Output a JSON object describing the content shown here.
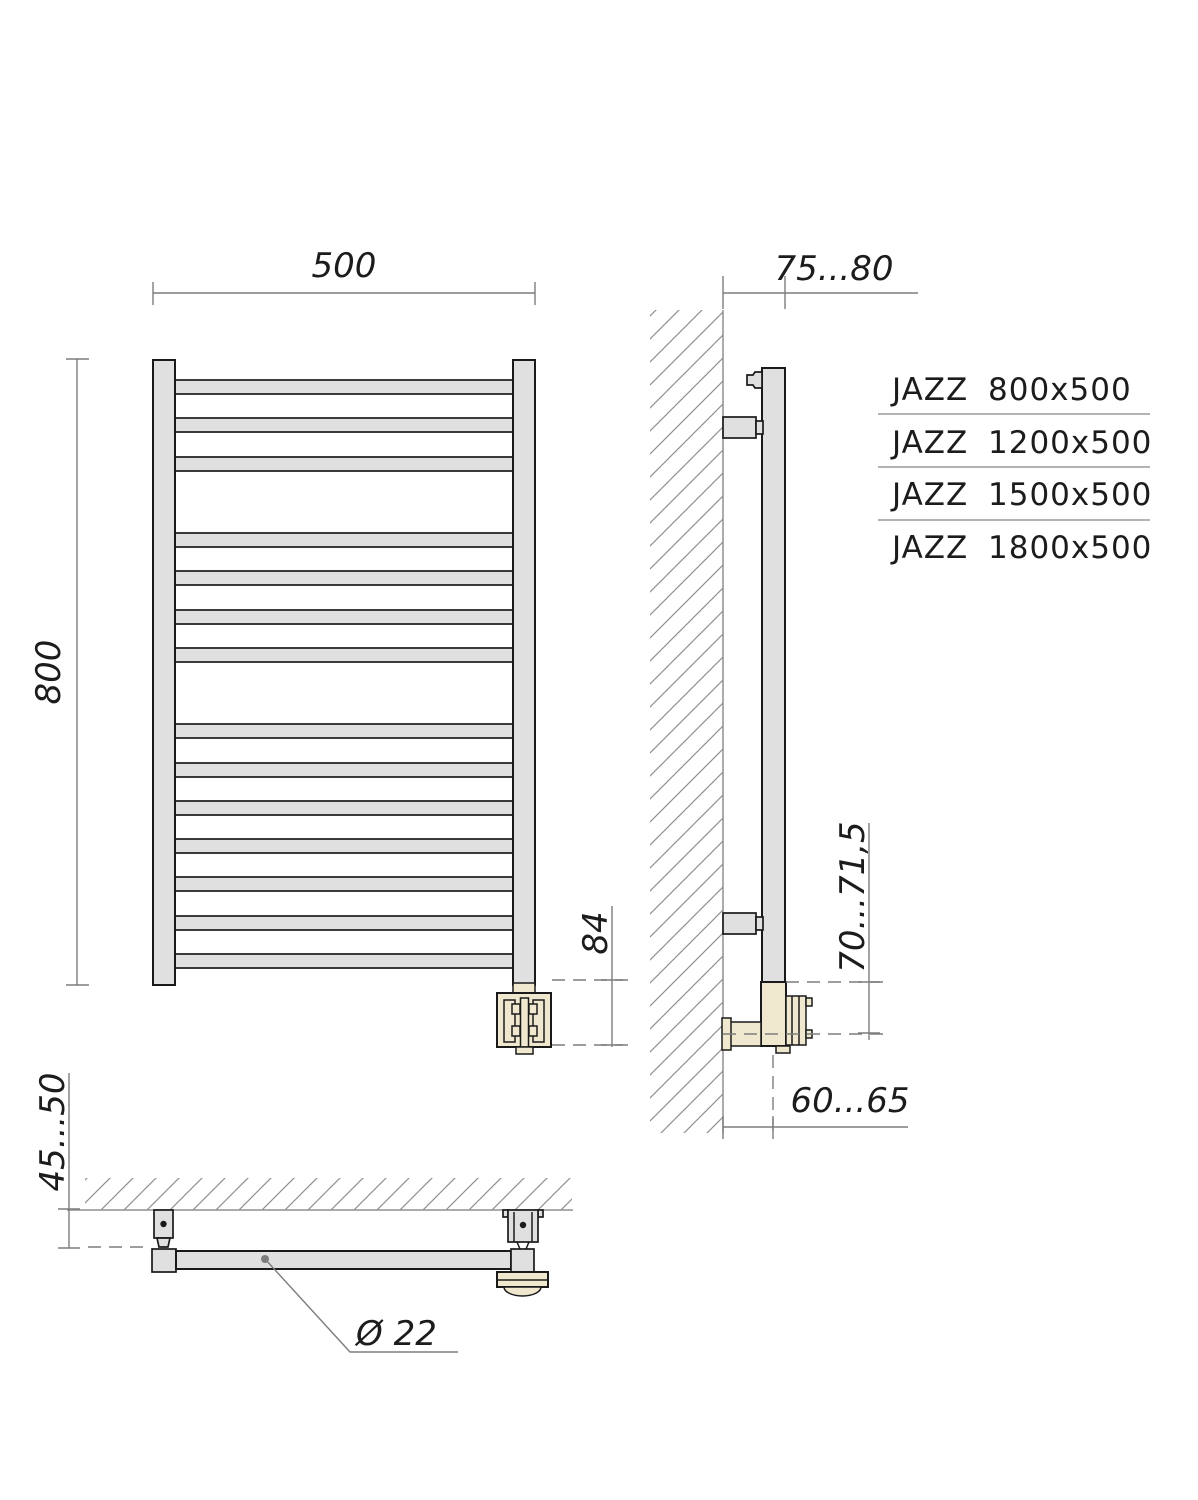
{
  "views": {
    "front": {
      "width_dim": "500",
      "height_dim": "800",
      "heater_offset_dim": "84"
    },
    "side": {
      "wall_offset_dim": "75...80",
      "connector_height_dim": "70...71,5",
      "connector_wall_offset_dim": "60...65"
    },
    "top": {
      "wall_gap_dim": "45...50",
      "tube_diameter_dim": "Ø 22"
    }
  },
  "models": [
    {
      "name": "JAZZ",
      "size": "800x500"
    },
    {
      "name": "JAZZ",
      "size": "1200x500"
    },
    {
      "name": "JAZZ",
      "size": "1500x500"
    },
    {
      "name": "JAZZ",
      "size": "1800x500"
    }
  ],
  "colors": {
    "tube_fill": "#e0e0e0",
    "fitting_fill": "#efe8ce",
    "outline": "#1a1a1a",
    "dimension_line": "#7d7d7d",
    "hatch_line": "#909090",
    "text": "#1c1c1c"
  }
}
